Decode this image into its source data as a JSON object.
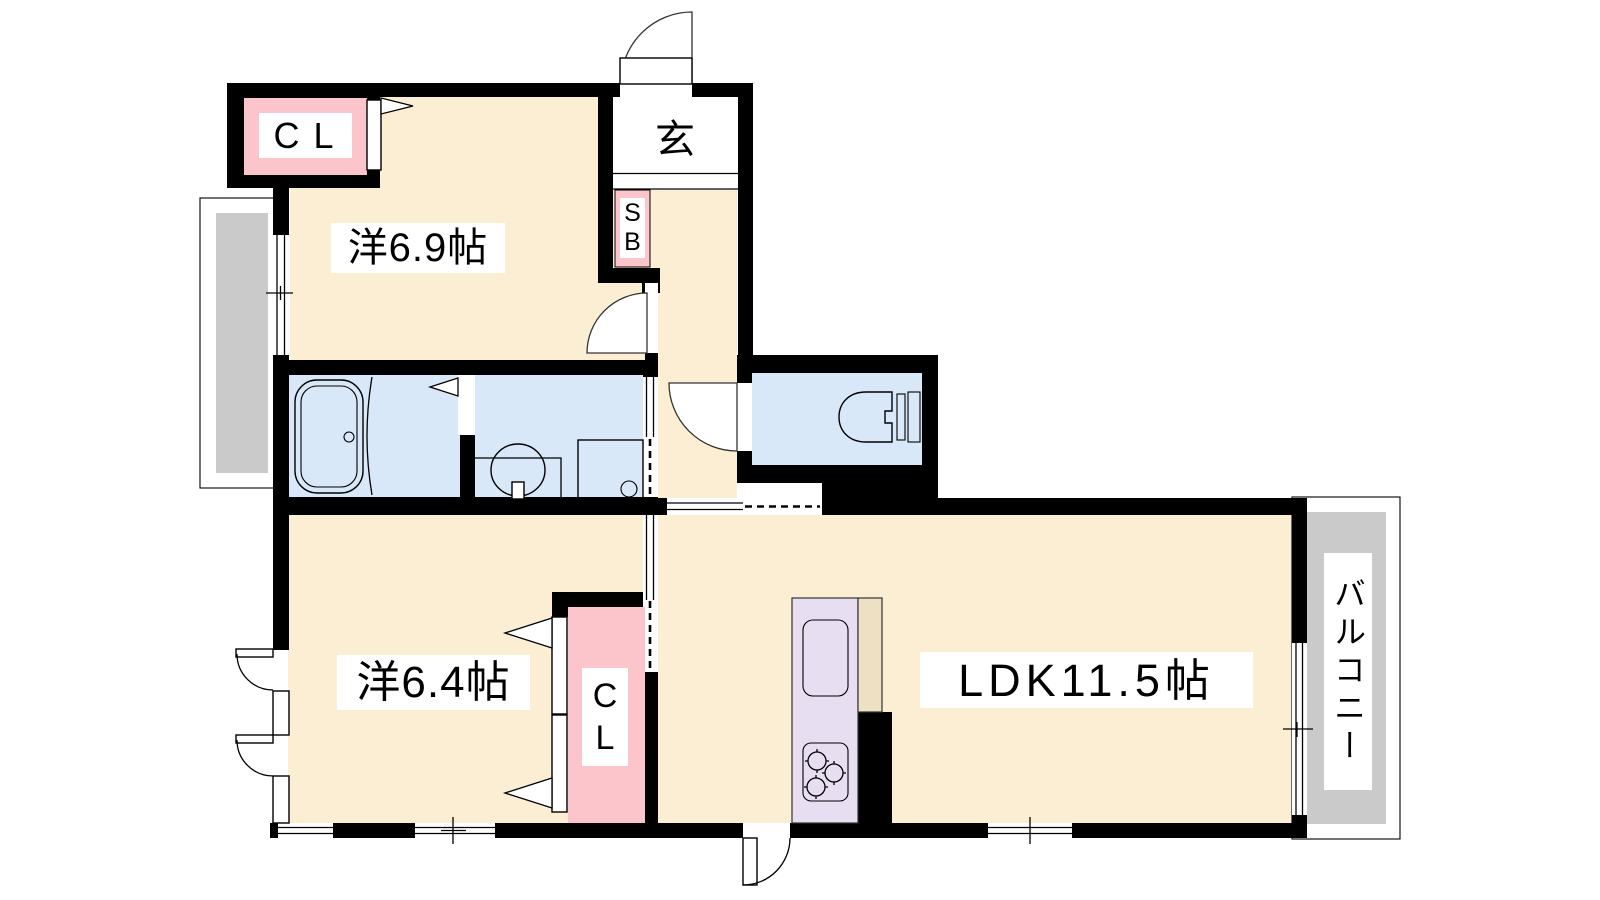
{
  "labels": {
    "room_top": "洋6.9帖",
    "room_bottom": "洋6.4帖",
    "ldk": "LDK11.5帖",
    "genkan": "玄",
    "balcony": "バルコニー",
    "closet_top": "CL",
    "closet_bottom_1": "C",
    "closet_bottom_2": "L",
    "shoebox_1": "S",
    "shoebox_2": "B"
  },
  "colors": {
    "floor": "#fbeed3",
    "wet": "#d9e8f8",
    "closet": "#fcc5cb",
    "gray": "#cacaca",
    "kitchen": "#e8def2",
    "cabinet": "#eee0c2",
    "wall": "#000000"
  }
}
